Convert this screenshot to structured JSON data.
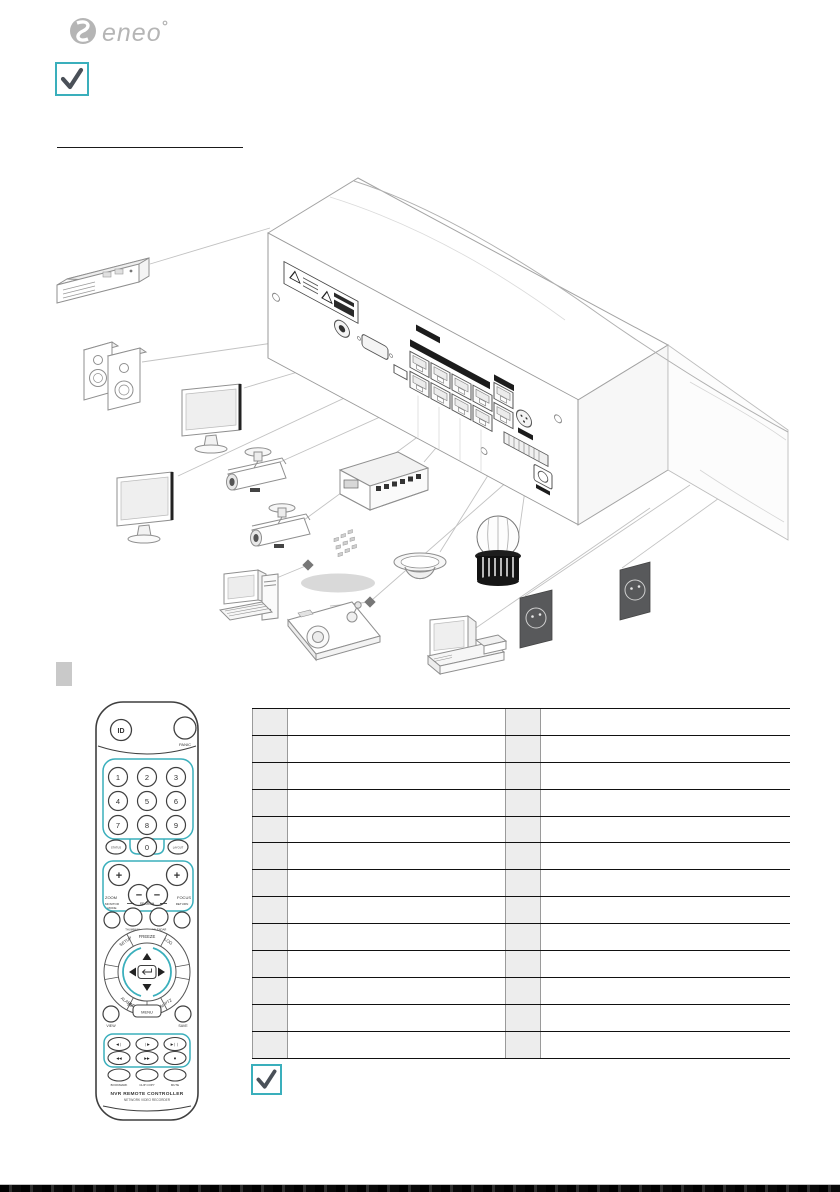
{
  "header": {
    "brand_logo": "eneo",
    "note_icon": "checkmark"
  },
  "colors": {
    "accent_teal": "#3aafbc",
    "check_gray": "#4a5058",
    "diagram_stroke": "#9a9a9a",
    "outlet_dark": "#58595b",
    "table_gray": "#ededed",
    "footer_bar": "#121212"
  },
  "diagram": {
    "devices": [
      "esata-storage-rack",
      "stereo-speakers",
      "monitor",
      "monitor",
      "bullet-camera",
      "bullet-camera",
      "poe-switch",
      "dome-camera",
      "alarm-siren",
      "pc-workstation",
      "ptz-keyboard-controller",
      "pos-terminal",
      "power-outlet",
      "power-outlet",
      "network-cloud",
      "nvr-rear-panel"
    ]
  },
  "remote": {
    "id_button": "ID",
    "panic_button": "PANIC",
    "digits": [
      "1",
      "2",
      "3",
      "4",
      "5",
      "6",
      "7",
      "8",
      "9"
    ],
    "zero_button": "0",
    "status_button": "STATUS",
    "layout_button": "LAYOUT",
    "zoom_label": "ZOOM",
    "focus_label": "FOCUS",
    "plus": "+",
    "minus": "−",
    "monitor_mode_line1": "MONITOR",
    "monitor_mode_line2": "MODE",
    "search_group_label": "SEARCH",
    "thumbnail_button": "THUMBNAIL",
    "calendar_button": "CALENDAR",
    "return_button": "RETURN",
    "ring": {
      "setup": "SETUP",
      "freeze": "FREEZE",
      "log": "LOG",
      "alarm": "ALARM",
      "sequence": "SEQUENCE",
      "zoom": "ZOOM",
      "ptz": "PTZ"
    },
    "view_button": "VIEW",
    "menu_button": "MENU",
    "save_button": "SAVE",
    "playback": {
      "step_back": "◀❘",
      "step_fwd": "❘▶",
      "play_pause": "▶❘❘",
      "rewind": "◀◀",
      "fast_fwd": "▶▶",
      "stop": "■"
    },
    "bookmark_button": "BOOKMARK",
    "clipcopy_button": "CLIP COPY",
    "mute_button": "MUTE",
    "brand_line1": "NVR REMOTE CONTROLLER",
    "brand_line2": "NETWORK VIDEO RECORDER"
  },
  "table": {
    "row_count": 13
  }
}
